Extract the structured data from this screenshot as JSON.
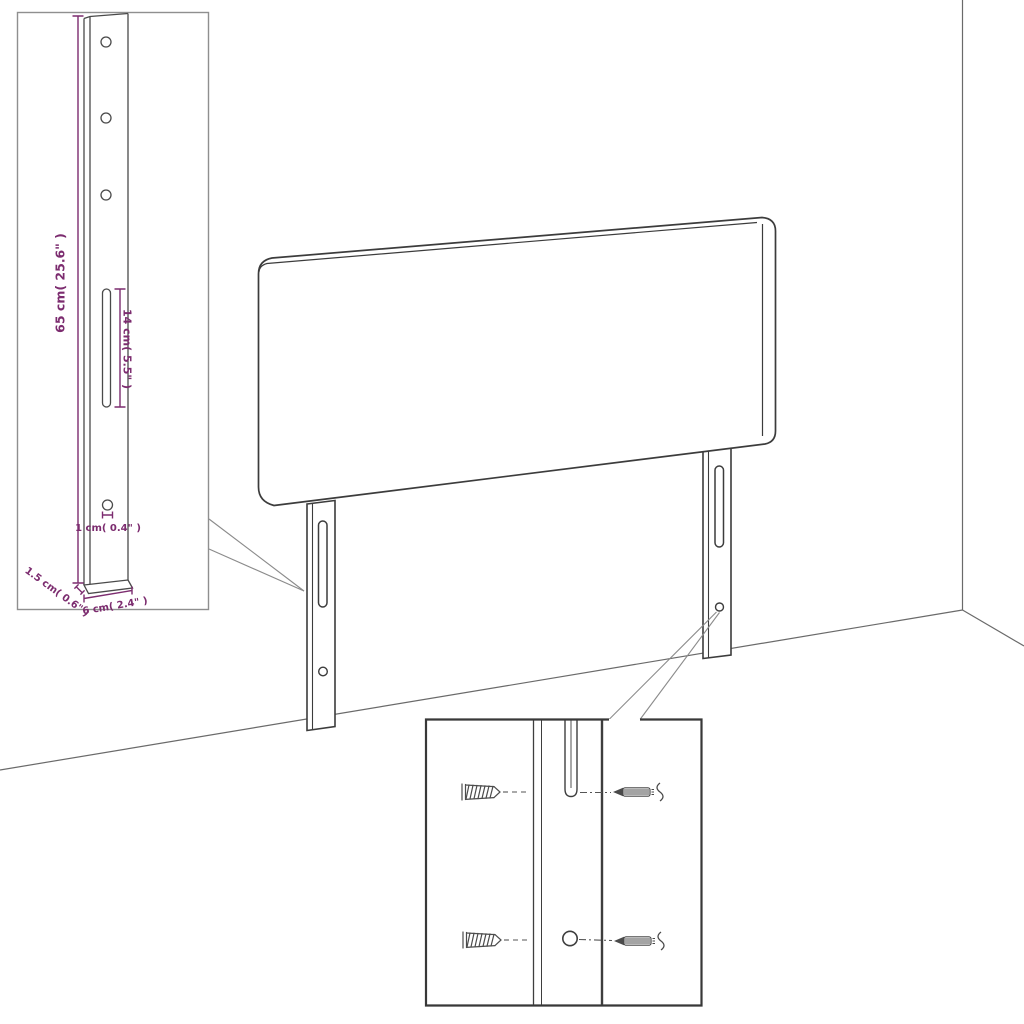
{
  "diagram": {
    "kind": "furniture-dimension-diagram",
    "subject": "headboard with two mounting legs shown against a room corner"
  },
  "colors": {
    "background": "#ffffff",
    "outline": "#3c3c3c",
    "room_lines": "#6a6a6a",
    "inset_border": "#8f8f8f",
    "dimension": "#7c2c6f"
  },
  "detail_top_left": {
    "dim_height": "65 cm( 25.6\" )",
    "dim_slot": "14 cm( 5.5\" )",
    "dim_hole": "1 cm( 0.4\" )",
    "dim_thickness": "1.5 cm( 0.6\" )",
    "dim_width": "6 cm( 2.4\" )"
  },
  "detail_bottom": {
    "icons": [
      "wall-plug-icon",
      "screw-icon",
      "mounting-slot",
      "mounting-hole"
    ]
  }
}
